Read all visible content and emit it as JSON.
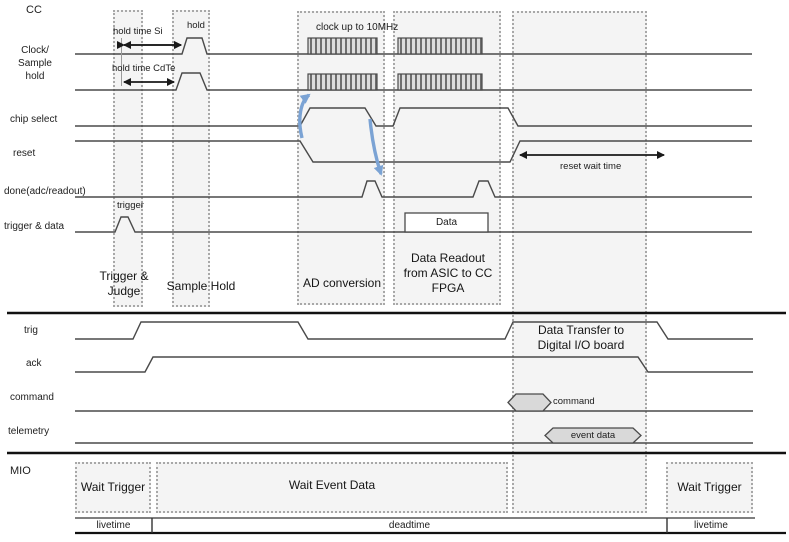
{
  "cc": {
    "section_label": "CC",
    "signal_labels": {
      "clock": "Clock/\nSample\nhold",
      "chip_select": "chip select",
      "reset": "reset",
      "done": "done(adc/readout)",
      "trigger_data": "trigger & data"
    },
    "annotations": {
      "hold_time_si": "hold time Si",
      "hold": "hold",
      "hold_time_cdte": "hold time CdTe",
      "clock_rate": "clock up to 10MHz",
      "trigger": "trigger",
      "data_box": "Data",
      "reset_wait": "reset wait time"
    },
    "phases": [
      {
        "label": "Trigger &\nJudge"
      },
      {
        "label": "Sample Hold"
      },
      {
        "label": "AD conversion"
      },
      {
        "label": "Data Readout\nfrom ASIC to CC\nFPGA"
      }
    ]
  },
  "io": {
    "signal_labels": {
      "trig": "trig",
      "ack": "ack",
      "command": "command",
      "telemetry": "telemetry"
    },
    "phase": {
      "label": "Data Transfer to\nDigital I/O board"
    },
    "bus_labels": {
      "command": "command",
      "event_data": "event data"
    }
  },
  "mio": {
    "section_label": "MIO",
    "states": [
      {
        "label": "Wait Trigger"
      },
      {
        "label": "Wait Event Data"
      },
      {
        "label": "Wait Trigger"
      }
    ],
    "timeline": [
      {
        "label": "livetime"
      },
      {
        "label": "deadtime"
      },
      {
        "label": "livetime"
      }
    ]
  },
  "colors": {
    "signal_line": "#4a4a4a",
    "blue_arrow": "#7ba3d4",
    "bus_fill": "#d9d9d9",
    "box_fill": "#f4f4f4",
    "box_border": "#a8a8a8"
  }
}
